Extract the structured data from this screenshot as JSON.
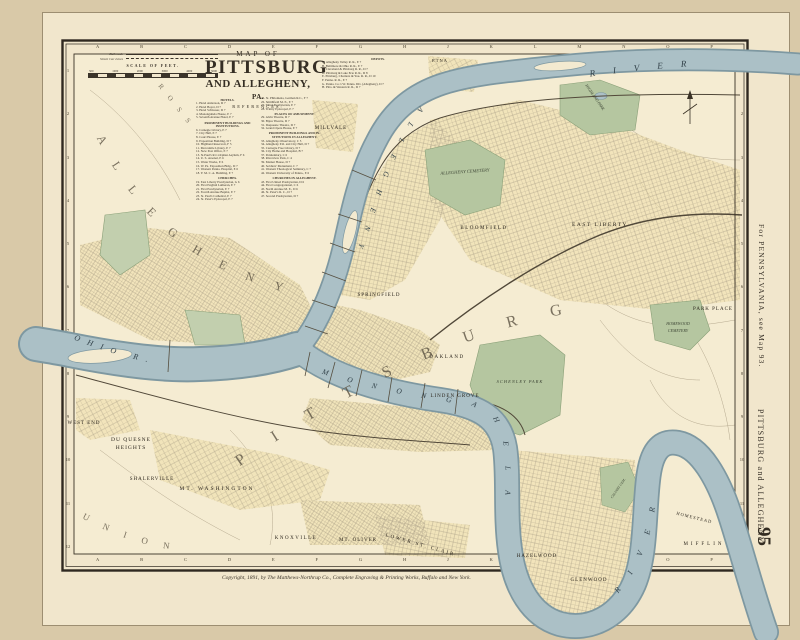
{
  "page": {
    "title": {
      "line1": "MAP OF",
      "line2": "PITTSBURG",
      "line3": "AND ALLEGHENY,",
      "line3_suffix": "PA.",
      "line4": "REFERENCES."
    },
    "sidebar": {
      "note": "For PENNSYLVANIA, see Map 93.",
      "title": "PITTSBURG and ALLEGHENY",
      "page_number": "95"
    },
    "copyright": "Copyright, 1891, by The Matthews-Northrup Co., Complete Engraving & Printing Works, Buffalo and New York.",
    "margins": {
      "top_letters": [
        "A",
        "B",
        "C",
        "D",
        "E",
        "F",
        "G",
        "H",
        "J",
        "K",
        "L",
        "M",
        "N",
        "O",
        "P"
      ],
      "bottom_letters": [
        "A",
        "B",
        "C",
        "D",
        "E",
        "F",
        "G",
        "H",
        "J",
        "K",
        "L",
        "M",
        "N",
        "O",
        "P"
      ],
      "left_numbers": [
        "1",
        "2",
        "3",
        "4",
        "5",
        "6",
        "7",
        "8",
        "9",
        "10",
        "11",
        "12"
      ],
      "right_numbers": [
        "1",
        "2",
        "3",
        "4",
        "5",
        "6",
        "7",
        "8",
        "9",
        "10",
        "11",
        "12"
      ]
    }
  },
  "legend": {
    "railroads": "Railroads",
    "street_car": "Street Car Lines",
    "scale_title": "SCALE OF FEET.",
    "scale_ticks": [
      "500",
      "1000",
      "2000",
      "3000",
      "4000",
      "5000"
    ]
  },
  "references": {
    "col1": [
      {
        "k": "h",
        "t": "HOTELS."
      },
      {
        "k": "i",
        "t": "1. Hotel Anderson, D 7"
      },
      {
        "k": "i",
        "t": "2. Hotel Boyer, D 7"
      },
      {
        "k": "i",
        "t": "3. Hotel Schlosser, D 7"
      },
      {
        "k": "i",
        "t": "4. Monongahela House, E 7"
      },
      {
        "k": "i",
        "t": "5. Seventh Avenue Hotel, E 7"
      },
      {
        "k": "h",
        "t": "PROMINENT BUILDINGS AND INSTITUTIONS."
      },
      {
        "k": "i",
        "t": "6. Carnegie Library, E 7"
      },
      {
        "k": "i",
        "t": "7. City Hall, E 7"
      },
      {
        "k": "i",
        "t": "8. Court House, E 7"
      },
      {
        "k": "i",
        "t": "9. Exposition Building, D 7"
      },
      {
        "k": "i",
        "t": "10. Highland Reservoir, F 5"
      },
      {
        "k": "i",
        "t": "11. Mercantile Library, E 7"
      },
      {
        "k": "i",
        "t": "12. New Post Office, E 7"
      },
      {
        "k": "i",
        "t": "13. St.Paul's R.C.Orphan Asylum, F 6"
      },
      {
        "k": "i",
        "t": "14. U. S. Arsenal, E 6"
      },
      {
        "k": "i",
        "t": "15. Water Works, E 6"
      },
      {
        "k": "i",
        "t": "16. W. Pa. Exposition Bldg., D 7"
      },
      {
        "k": "i",
        "t": "17. Western Penna. Hospital, E 6"
      },
      {
        "k": "i",
        "t": "18. Y. M. C. A. Building, E 7"
      },
      {
        "k": "h",
        "t": "CHURCHES."
      },
      {
        "k": "i",
        "t": "19. East Liberty Presbyterian, G 6"
      },
      {
        "k": "i",
        "t": "20. First English Lutheran, E 7"
      },
      {
        "k": "i",
        "t": "21. First Presbyterian, E 7"
      },
      {
        "k": "i",
        "t": "22. Fourth Avenue Baptist, E 7"
      },
      {
        "k": "i",
        "t": "23. St. Paul's Cathedral, E 7"
      },
      {
        "k": "i",
        "t": "24. St. Peter's Episcopal, E 7"
      }
    ],
    "col2": [
      {
        "k": "i",
        "t": "25. St. Philomena, German R.C., F 7"
      },
      {
        "k": "i",
        "t": "26. Smithfield M. E., E 7"
      },
      {
        "k": "i",
        "t": "27. Third Presbyterian, E 7"
      },
      {
        "k": "i",
        "t": "28. Trinity Episcopal, E 7"
      },
      {
        "k": "h",
        "t": "PLACES OF AMUSEMENT."
      },
      {
        "k": "i",
        "t": "29. Alvin Theatre, D 7"
      },
      {
        "k": "i",
        "t": "30. Bijou Theatre, D 7"
      },
      {
        "k": "i",
        "t": "31. Duquesne Theatre, D 7"
      },
      {
        "k": "i",
        "t": "32. Grand Opera House, E 7"
      },
      {
        "k": "h",
        "t": "PROMINENT BUILDINGS AND IN-STITUTIONS IN ALLEGHENY."
      },
      {
        "k": "i",
        "t": "33. Allegheny Observatory, C 5"
      },
      {
        "k": "i",
        "t": "34. Allegheny P.O. and City Hall, D 7"
      },
      {
        "k": "i",
        "t": "35. Carnegie Free Library, D 7"
      },
      {
        "k": "i",
        "t": "36. City Home and Hospital, B 7"
      },
      {
        "k": "i",
        "t": "37. Penitentiary, C 6"
      },
      {
        "k": "i",
        "t": "38. Riverview Park, C 4"
      },
      {
        "k": "i",
        "t": "39. Market House, D 7"
      },
      {
        "k": "i",
        "t": "40. Soldiers' Monument, C 7"
      },
      {
        "k": "i",
        "t": "41. Western Theological Seminary, C 7"
      },
      {
        "k": "i",
        "t": "42. Western University of Penna., E 6"
      },
      {
        "k": "h",
        "t": "CHURCHES IN ALLEGHENY."
      },
      {
        "k": "i",
        "t": "43. First United Presbyterian, D 6"
      },
      {
        "k": "i",
        "t": "44. First Congregational, C 6"
      },
      {
        "k": "i",
        "t": "45. North Avenue M. E., D 6"
      },
      {
        "k": "i",
        "t": "46. St. Peter's R. C., D 7"
      },
      {
        "k": "i",
        "t": "47. Second Presbyterian, D 7"
      }
    ],
    "depots": [
      {
        "k": "h",
        "t": "DEPOTS."
      },
      {
        "k": "i",
        "t": "A. Allegheny Valley R. R., E 7"
      },
      {
        "k": "i",
        "t": "B. Baltimore & Ohio R. R., E 7"
      },
      {
        "k": "i",
        "t": "C. Cleveland & Pittsburg R. R., D 7"
      },
      {
        "k": "i",
        "t": "D. Pittsburg & Lake Erie R. R., D 8"
      },
      {
        "k": "i",
        "t": "E. Pittsburg, Chartiers & You. R. R., D 10"
      },
      {
        "k": "i",
        "t": "F. Penna. R. R., E 7"
      },
      {
        "k": "i",
        "t": "G. Penna. Co.'s W. Penna. Div. (Allegheny), D 7"
      },
      {
        "k": "i",
        "t": "H. Pitts. & Western R. R., D 7"
      }
    ]
  },
  "map": {
    "big_labels": {
      "pittsburg": "PITTSBURG",
      "allegheny_city": "ALLEGHENY",
      "ross": "ROSS",
      "union": "UNION"
    },
    "river_labels": {
      "river_top": "RIVER",
      "allegheny": "ALLEGHENY",
      "monongahela": "MONONGAHELA",
      "river_loop": "RIVER",
      "ohio": "OHIO R."
    },
    "towns": {
      "etna": "ETNA",
      "millvale": "MILLVALE",
      "bloomfield": "BLOOMFIELD",
      "east_liberty": "EAST LIBERTY",
      "park_place": "PARK PLACE",
      "springfield": "SPRINGFIELD",
      "oakland": "OAKLAND",
      "linden_grove": "LINDEN GROVE",
      "west_end": "WEST END",
      "duquesne1": "DU QUESNE",
      "duquesne2": "HEIGHTS",
      "shalerville": "SHALERVILLE",
      "mt_washington": "MT. WASHINGTON",
      "knoxville": "KNOXVILLE",
      "mt_oliver": "MT. OLIVER",
      "lower_st_clair": "LOWER ST. CLAIR",
      "hazelwood": "HAZELWOOD",
      "glenwood": "GLENWOOD",
      "homestead": "HOMESTEAD",
      "mifflin": "MIFFLIN"
    },
    "parks": {
      "allegheny_cemetery": "ALLEGHENY CEMETERY",
      "highland_park": "HIGHLAND PARK",
      "schenley_park": "SCHENLEY PARK",
      "homewood1": "HOMEWOOD",
      "homewood2": "CEMETERY",
      "calvary": "CALVARY CEM."
    }
  }
}
